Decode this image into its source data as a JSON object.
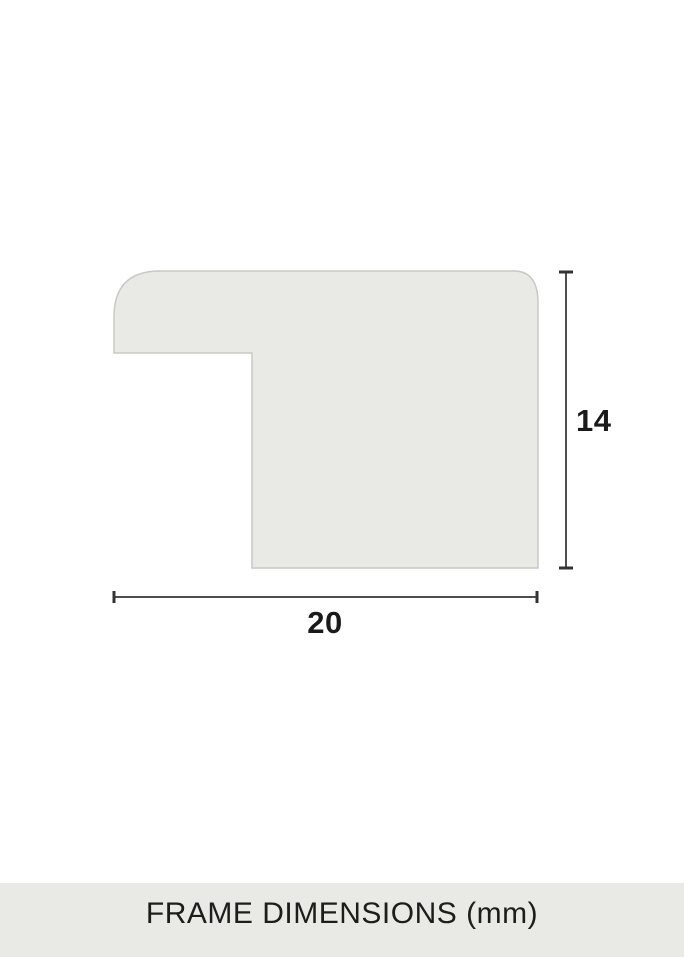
{
  "colors": {
    "background": "#ffffff",
    "profile_fill": "#e9eae6",
    "profile_stroke": "#c7c9c4",
    "dimension_line": "#4d4d4d",
    "dimension_cap": "#333333",
    "label_text": "#1a1a1a",
    "footer_background": "#e9e9e5",
    "footer_text": "#1d1d1b"
  },
  "diagram": {
    "type": "frame-moulding-cross-section",
    "height_label": "14",
    "width_label": "20"
  },
  "footer": {
    "caption": "FRAME DIMENSIONS (mm)"
  }
}
